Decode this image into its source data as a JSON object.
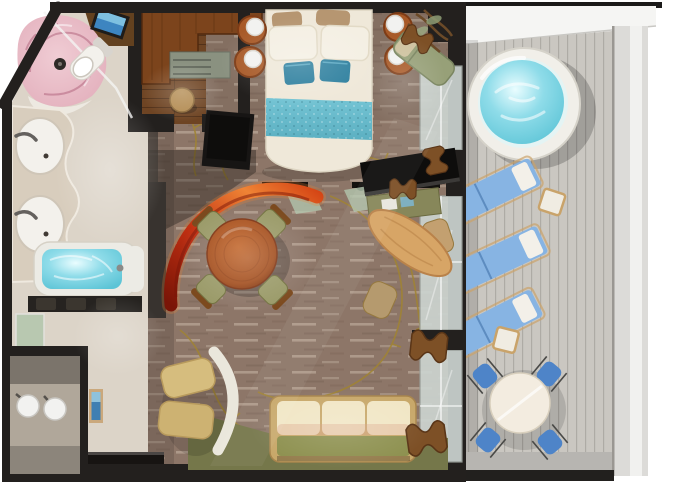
{
  "scene": {
    "type": "floor-plan-rendering",
    "subject": "top-down 3D rendering of a ship suite with private balcony",
    "rooms": [
      {
        "name": "bathroom",
        "furniture": [
          "curved pink glass shower",
          "toilet",
          "double-sink vanity",
          "bathtub",
          "glass door"
        ]
      },
      {
        "name": "walk-in-closet",
        "furniture": [
          "L-shaped wardrobe",
          "drawer cabinet",
          "round stool"
        ]
      },
      {
        "name": "bedroom",
        "furniture": [
          "double bed with teal runner",
          "teal accent pillows",
          "copper nightstand lamps",
          "tv cabinet",
          "window bench"
        ]
      },
      {
        "name": "living-dining-room",
        "furniture": [
          "red glass arc partition",
          "round dining table",
          "four dining chairs",
          "desk",
          "flat tv",
          "oval coffee table",
          "sofa",
          "gold armchair",
          "curtained glass doors"
        ]
      },
      {
        "name": "entry-hall",
        "furniture": [
          "globe wall lamps",
          "black console",
          "framed artwork"
        ]
      },
      {
        "name": "balcony",
        "furniture": [
          "round hot tub",
          "three sun loungers",
          "side tables",
          "bistro table",
          "four bistro chairs",
          "plank deck",
          "white railing"
        ]
      }
    ]
  },
  "palette": {
    "page_bg": "#ffffff",
    "wall_dark": "#23201e",
    "wall_medium": "#38332f",
    "carpet_base": "#8d7668",
    "carpet_vine_gold": "#a08433",
    "floor_beige": "#dcd4c8",
    "wood_floor": "#6e4423",
    "wardrobe_wood": "#7c441c",
    "cabinet_sage": "#8a9180",
    "stool_tan": "#b28a50",
    "shower_glass_pink": "#e2aebb",
    "porcelain": "#f3f1ec",
    "tub_water": "#8fdce9",
    "tub_water_deep": "#5cc4d6",
    "bed_linen": "#efe8d9",
    "pillow_brown": "#b69671",
    "accent_teal": "#2d7f9e",
    "runner_teal": "#5cb0c2",
    "lamp_copper": "#a85a28",
    "lamp_globe": "#f2f2f0",
    "bench_sage": "#97a078",
    "tv_black": "#0e0d0c",
    "arc_deep": "#7a1507",
    "arc_red": "#c23012",
    "arc_orange": "#ef8435",
    "table_wood": "#a14c1c",
    "chair_olive": "#9a9a68",
    "chair_wood": "#7c4a1e",
    "desk_olive": "#87875a",
    "oval_wood": "#d7a566",
    "chair_tan": "#c3a070",
    "sofa_frame": "#c8a86a",
    "sofa_cushion": "#f1e6c5",
    "sofa_seat": "#8e9150",
    "rug_olive": "#75774a",
    "armchair_gold": "#d6bd7e",
    "armchair_back": "#eae7dc",
    "curtain_brown": "#7d5026",
    "glass_door": "#ccd4d0",
    "glass_green": "#b2c6ac",
    "console_black": "#171412",
    "entry_floor": "#b0a79a",
    "deck_plank": "#cac7c1",
    "deck_concrete": "#b7b5b1",
    "railing_white": "#f5f5f3",
    "railing_gray": "#dcdbd8",
    "hot_tub_rim": "#f1efe9",
    "lounger_blue": "#87b4e3",
    "lounger_pillow": "#f3f0e9",
    "bistro_blue": "#4e84c8",
    "bistro_table": "#f3ece0"
  }
}
